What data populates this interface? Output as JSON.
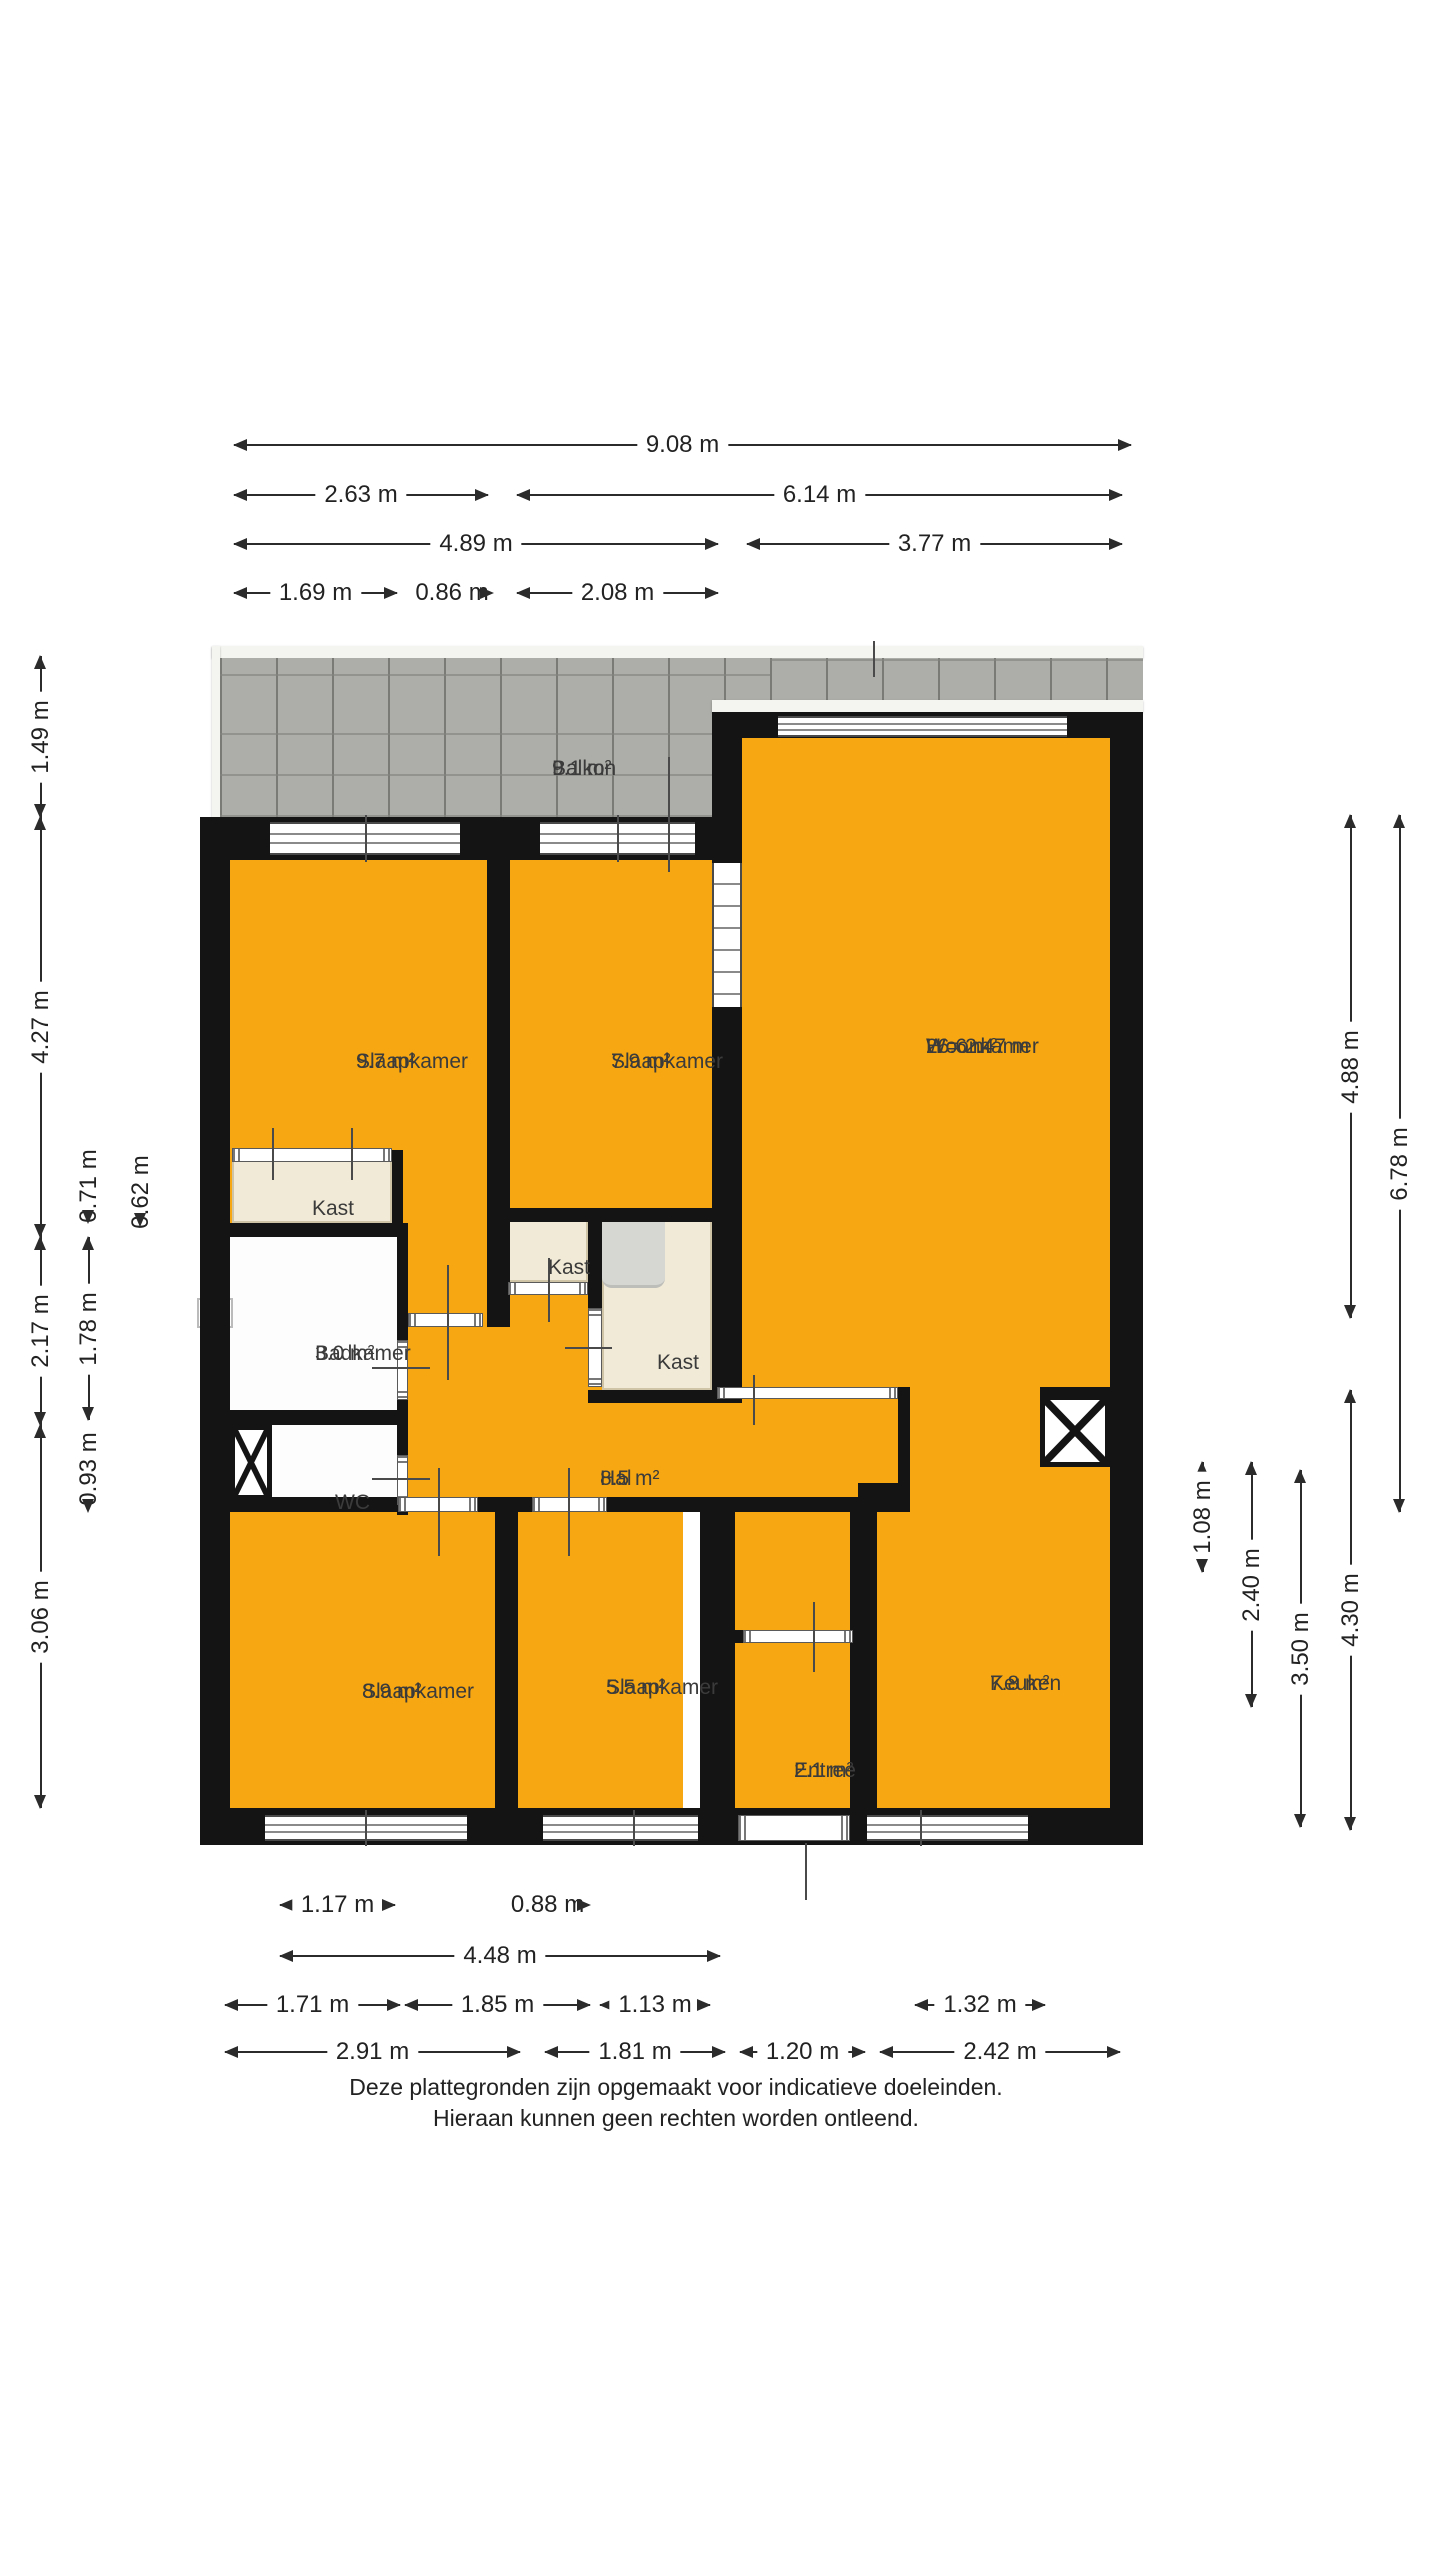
{
  "colors": {
    "room_fill": "#F7A711",
    "wall": "#141414",
    "closet_fill": "#F1EAD6",
    "balcony_tile": "#ADADA9",
    "fixture_gray": "#D6D6D3"
  },
  "rooms": {
    "balkon": {
      "label": "Balkon",
      "area": "9.1 m²"
    },
    "slaapkamer1": {
      "label": "Slaapkamer",
      "area": "9.7 m²"
    },
    "slaapkamer2": {
      "label": "Slaapkamer",
      "area": "7.9 m²"
    },
    "woonkamer": {
      "label": "Woonkamer",
      "height": "H = 2.47 m",
      "area": "26.6 m²"
    },
    "kast_links": {
      "label": "Kast"
    },
    "kast_midden": {
      "label": "Kast"
    },
    "kast_rechts": {
      "label": "Kast"
    },
    "badkamer": {
      "label": "Badkamer",
      "area": "3.0 m²"
    },
    "wc": {
      "label": "WC"
    },
    "hal": {
      "label": "Hal",
      "area": "8.5 m²"
    },
    "slaapkamer3": {
      "label": "Slaapkamer",
      "area": "8.9 m²"
    },
    "slaapkamer4": {
      "label": "Slaapkamer",
      "area": "5.5 m²"
    },
    "entree": {
      "label": "Entree",
      "area": "2.1 m²"
    },
    "keuken": {
      "label": "Keuken",
      "area": "7.8 m²"
    }
  },
  "dimensions": [
    {
      "name": "top-total",
      "label": "9.08 m",
      "o": "h",
      "x": 234,
      "y": 444,
      "len": 897
    },
    {
      "name": "top-left-2",
      "label": "2.63 m",
      "o": "h",
      "x": 234,
      "y": 494,
      "len": 254
    },
    {
      "name": "top-right-2",
      "label": "6.14 m",
      "o": "h",
      "x": 517,
      "y": 494,
      "len": 605
    },
    {
      "name": "top-left-3",
      "label": "4.89 m",
      "o": "h",
      "x": 234,
      "y": 543,
      "len": 484
    },
    {
      "name": "top-right-3",
      "label": "3.77 m",
      "o": "h",
      "x": 747,
      "y": 543,
      "len": 375
    },
    {
      "name": "top-4a",
      "label": "1.69 m",
      "o": "h",
      "x": 234,
      "y": 592,
      "len": 163
    },
    {
      "name": "top-4b",
      "label": "0.86 m",
      "o": "h",
      "x": 411,
      "y": 592,
      "len": 82
    },
    {
      "name": "top-4c",
      "label": "2.08 m",
      "o": "h",
      "x": 517,
      "y": 592,
      "len": 201
    },
    {
      "name": "left-balkon",
      "label": "1.49 m",
      "o": "v",
      "x": 40,
      "y": 656,
      "len": 161
    },
    {
      "name": "left-slaapkamer",
      "label": "4.27 m",
      "o": "v",
      "x": 40,
      "y": 817,
      "len": 420
    },
    {
      "name": "left-badkamer",
      "label": "2.17 m",
      "o": "v",
      "x": 40,
      "y": 1237,
      "len": 188
    },
    {
      "name": "left-onder",
      "label": "3.06 m",
      "o": "v",
      "x": 40,
      "y": 1425,
      "len": 383
    },
    {
      "name": "left-kast",
      "label": "0.71 m",
      "o": "v",
      "x": 88,
      "y": 1148,
      "len": 75
    },
    {
      "name": "left-badkamer-in",
      "label": "1.78 m",
      "o": "v",
      "x": 88,
      "y": 1237,
      "len": 183
    },
    {
      "name": "left-wc",
      "label": "0.93 m",
      "o": "v",
      "x": 88,
      "y": 1425,
      "len": 87
    },
    {
      "name": "left-kast-diep",
      "label": "0.62 m",
      "o": "v",
      "x": 140,
      "y": 1158,
      "len": 68
    },
    {
      "name": "right-1",
      "label": "1.08 m",
      "o": "v",
      "x": 1202,
      "y": 1462,
      "len": 110
    },
    {
      "name": "right-2",
      "label": "2.40 m",
      "o": "v",
      "x": 1251,
      "y": 1462,
      "len": 245
    },
    {
      "name": "right-3",
      "label": "3.50 m",
      "o": "v",
      "x": 1300,
      "y": 1470,
      "len": 357
    },
    {
      "name": "right-woonkamer",
      "label": "4.88 m",
      "o": "v",
      "x": 1350,
      "y": 815,
      "len": 503
    },
    {
      "name": "right-keuken",
      "label": "4.30 m",
      "o": "v",
      "x": 1350,
      "y": 1390,
      "len": 440
    },
    {
      "name": "right-totaal",
      "label": "6.78 m",
      "o": "v",
      "x": 1399,
      "y": 815,
      "len": 697
    },
    {
      "name": "bottom-1a",
      "label": "1.17 m",
      "o": "h",
      "x": 280,
      "y": 1904,
      "len": 115
    },
    {
      "name": "bottom-1b",
      "label": "0.88 m",
      "o": "h",
      "x": 505,
      "y": 1904,
      "len": 85
    },
    {
      "name": "bottom-2",
      "label": "4.48 m",
      "o": "h",
      "x": 280,
      "y": 1955,
      "len": 440
    },
    {
      "name": "bottom-3a",
      "label": "1.71 m",
      "o": "h",
      "x": 225,
      "y": 2004,
      "len": 175
    },
    {
      "name": "bottom-3b",
      "label": "1.85 m",
      "o": "h",
      "x": 405,
      "y": 2004,
      "len": 185
    },
    {
      "name": "bottom-3c",
      "label": "1.13 m",
      "o": "h",
      "x": 600,
      "y": 2004,
      "len": 110
    },
    {
      "name": "bottom-3d",
      "label": "1.32 m",
      "o": "h",
      "x": 915,
      "y": 2004,
      "len": 130
    },
    {
      "name": "bottom-4a",
      "label": "2.91 m",
      "o": "h",
      "x": 225,
      "y": 2051,
      "len": 295
    },
    {
      "name": "bottom-4b",
      "label": "1.81 m",
      "o": "h",
      "x": 545,
      "y": 2051,
      "len": 180
    },
    {
      "name": "bottom-4c",
      "label": "1.20 m",
      "o": "h",
      "x": 740,
      "y": 2051,
      "len": 125
    },
    {
      "name": "bottom-4d",
      "label": "2.42 m",
      "o": "h",
      "x": 880,
      "y": 2051,
      "len": 240
    }
  ],
  "footer": {
    "line1": "Deze plattegronden zijn opgemaakt voor indicatieve doeleinden.",
    "line2": "Hieraan kunnen geen rechten worden ontleend."
  }
}
